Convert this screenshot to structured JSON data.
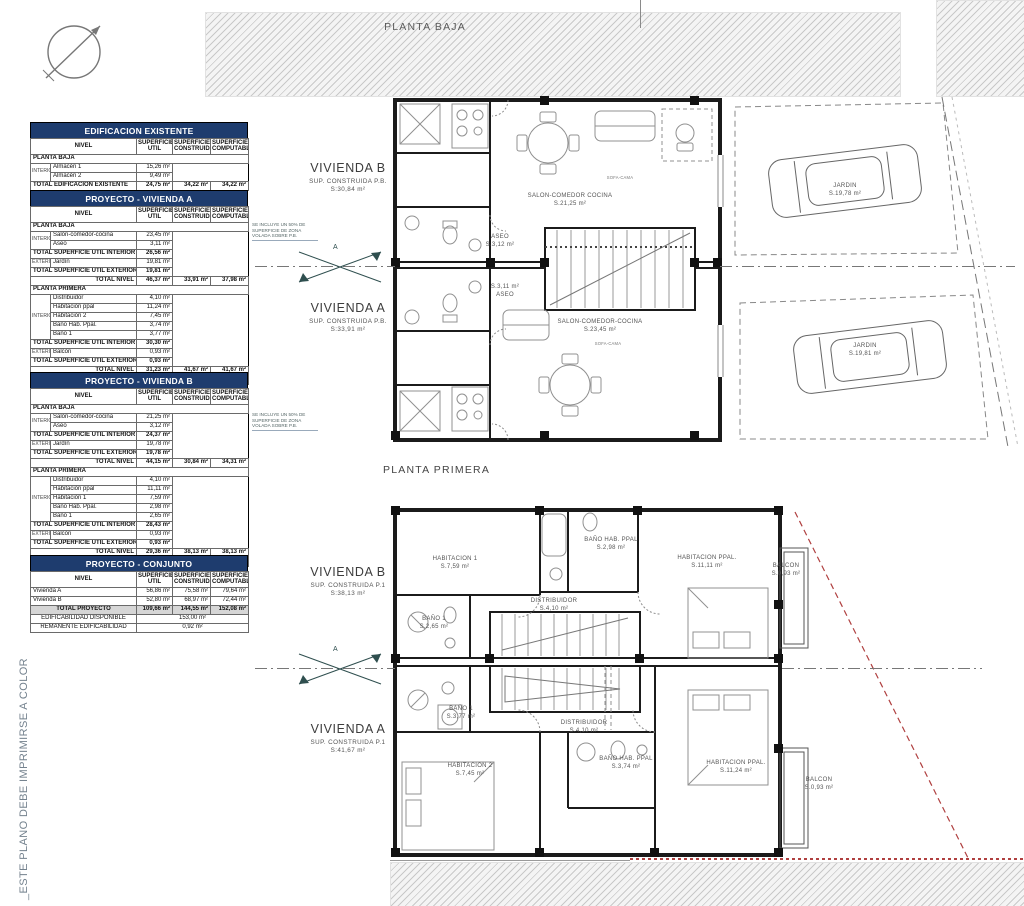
{
  "colors": {
    "table_header_bg": "#1e3c6e",
    "red_boundary": "#b04040",
    "side_note_color": "#74828e"
  },
  "side_note": "_ESTE PLANO DEBE IMPRIMIRSE A COLOR",
  "section_marker_label": "A",
  "tables": [
    {
      "title": "EDIFICACION EXISTENTE",
      "rows": [
        [
          {
            "t": "NIVEL",
            "cs": 2,
            "c": "hdr"
          },
          {
            "t": "SUPERFICIE UTIL",
            "c": "hdr"
          },
          {
            "t": "SUPERFICIE CONSTRUIDA",
            "c": "hdr"
          },
          {
            "t": "SUPERFICIE COMPUTABLE",
            "c": "hdr"
          }
        ],
        [
          {
            "t": "PLANTA BAJA",
            "cs": 5,
            "c": "sec"
          }
        ],
        [
          {
            "t": "INTERIOR",
            "rs": 2,
            "c": "grp"
          },
          {
            "t": "Almacén 1",
            "c": "lbl"
          },
          {
            "t": "15,26 m²",
            "c": "num"
          },
          {
            "t": "",
            "c": "blank"
          },
          {
            "t": "",
            "c": "blank"
          }
        ],
        [
          {
            "t": "Almacén 2",
            "c": "lbl"
          },
          {
            "t": "9,49 m²",
            "c": "num"
          },
          {
            "t": "",
            "c": "blank"
          },
          {
            "t": "",
            "c": "blank"
          }
        ],
        [
          {
            "t": "TOTAL EDIFICACION EXISTENTE",
            "cs": 2,
            "c": "b lbl"
          },
          {
            "t": "24,75 m²",
            "c": "num b"
          },
          {
            "t": "34,22 m²",
            "c": "num b"
          },
          {
            "t": "34,22 m²",
            "c": "num b"
          }
        ]
      ]
    },
    {
      "title": "PROYECTO - VIVIENDA A",
      "rows": [
        [
          {
            "t": "NIVEL",
            "cs": 2,
            "c": "hdr"
          },
          {
            "t": "SUPERFICIE UTIL",
            "c": "hdr"
          },
          {
            "t": "SUPERFICIE CONSTRUIDA",
            "c": "hdr"
          },
          {
            "t": "SUPERFICIE COMPUTABLE",
            "c": "hdr"
          }
        ],
        [
          {
            "t": "PLANTA BAJA",
            "cs": 5,
            "c": "sec"
          }
        ],
        [
          {
            "t": "INTERIOR",
            "rs": 2,
            "c": "grp"
          },
          {
            "t": "Salón-comedor-cocina",
            "c": "lbl"
          },
          {
            "t": "23,45 m²",
            "c": "num"
          },
          {
            "t": "",
            "c": "blank"
          },
          {
            "t": "",
            "c": "blank"
          }
        ],
        [
          {
            "t": "Aseo",
            "c": "lbl"
          },
          {
            "t": "3,11 m²",
            "c": "num"
          },
          {
            "t": "",
            "c": "blank"
          },
          {
            "t": "",
            "c": "blank"
          }
        ],
        [
          {
            "t": "TOTAL SUPERFICIE UTIL INTERIOR",
            "cs": 2,
            "c": "b lbl"
          },
          {
            "t": "26,56 m²",
            "c": "num b"
          },
          {
            "t": "",
            "c": "blank"
          },
          {
            "t": "",
            "c": "blank"
          }
        ],
        [
          {
            "t": "EXTERIOR",
            "c": "grp"
          },
          {
            "t": "Jardín",
            "c": "lbl"
          },
          {
            "t": "19,81 m²",
            "c": "num"
          },
          {
            "t": "",
            "c": "blank"
          },
          {
            "t": "",
            "c": "blank"
          }
        ],
        [
          {
            "t": "TOTAL SUPERFICIE UTIL EXTERIOR",
            "cs": 2,
            "c": "b lbl"
          },
          {
            "t": "19,81 m²",
            "c": "num b"
          },
          {
            "t": "",
            "c": "blank"
          },
          {
            "t": "",
            "c": "blank"
          }
        ],
        [
          {
            "t": "TOTAL NIVEL",
            "cs": 2,
            "c": "b r"
          },
          {
            "t": "46,37 m²",
            "c": "num b"
          },
          {
            "t": "33,91 m²",
            "c": "num b"
          },
          {
            "t": "37,98 m²",
            "c": "num b"
          }
        ],
        [
          {
            "t": "PLANTA PRIMERA",
            "cs": 5,
            "c": "sec"
          }
        ],
        [
          {
            "t": "INTERIOR",
            "rs": 5,
            "c": "grp"
          },
          {
            "t": "Distribuidor",
            "c": "lbl"
          },
          {
            "t": "4,10 m²",
            "c": "num"
          },
          {
            "t": "",
            "c": "blank"
          },
          {
            "t": "",
            "c": "blank"
          }
        ],
        [
          {
            "t": "Habitación ppal",
            "c": "lbl"
          },
          {
            "t": "11,24 m²",
            "c": "num"
          },
          {
            "t": "",
            "c": "blank"
          },
          {
            "t": "",
            "c": "blank"
          }
        ],
        [
          {
            "t": "Habitación 2",
            "c": "lbl"
          },
          {
            "t": "7,45 m²",
            "c": "num"
          },
          {
            "t": "",
            "c": "blank"
          },
          {
            "t": "",
            "c": "blank"
          }
        ],
        [
          {
            "t": "Baño Hab. Ppal.",
            "c": "lbl"
          },
          {
            "t": "3,74 m²",
            "c": "num"
          },
          {
            "t": "",
            "c": "blank"
          },
          {
            "t": "",
            "c": "blank"
          }
        ],
        [
          {
            "t": "Baño 1",
            "c": "lbl"
          },
          {
            "t": "3,77 m²",
            "c": "num"
          },
          {
            "t": "",
            "c": "blank"
          },
          {
            "t": "",
            "c": "blank"
          }
        ],
        [
          {
            "t": "TOTAL SUPERFICIE UTIL INTERIOR",
            "cs": 2,
            "c": "b lbl"
          },
          {
            "t": "30,30 m²",
            "c": "num b"
          },
          {
            "t": "",
            "c": "blank"
          },
          {
            "t": "",
            "c": "blank"
          }
        ],
        [
          {
            "t": "EXTERIOR",
            "c": "grp"
          },
          {
            "t": "Balcón",
            "c": "lbl"
          },
          {
            "t": "0,93 m²",
            "c": "num"
          },
          {
            "t": "",
            "c": "blank"
          },
          {
            "t": "",
            "c": "blank"
          }
        ],
        [
          {
            "t": "TOTAL SUPERFICIE UTIL EXTERIOR",
            "cs": 2,
            "c": "b lbl"
          },
          {
            "t": "0,93 m²",
            "c": "num b"
          },
          {
            "t": "",
            "c": "blank"
          },
          {
            "t": "",
            "c": "blank"
          }
        ],
        [
          {
            "t": "TOTAL NIVEL",
            "cs": 2,
            "c": "b r"
          },
          {
            "t": "31,23 m²",
            "c": "num b"
          },
          {
            "t": "41,67 m²",
            "c": "num b"
          },
          {
            "t": "41,67 m²",
            "c": "num b"
          }
        ],
        [
          {
            "t": "TOTAL VIVIENDA PROYECTO",
            "cs": 2,
            "c": "b lbl gray"
          },
          {
            "t": "56,86 m²",
            "c": "num b gray"
          },
          {
            "t": "75,58 m²",
            "c": "num b gray"
          },
          {
            "t": "79,64 m²",
            "c": "num b gray"
          }
        ]
      ]
    },
    {
      "title": "PROYECTO - VIVIENDA B",
      "rows": [
        [
          {
            "t": "NIVEL",
            "cs": 2,
            "c": "hdr"
          },
          {
            "t": "SUPERFICIE UTIL",
            "c": "hdr"
          },
          {
            "t": "SUPERFICIE CONSTRUIDA",
            "c": "hdr"
          },
          {
            "t": "SUPERFICIE COMPUTABLE",
            "c": "hdr"
          }
        ],
        [
          {
            "t": "PLANTA BAJA",
            "cs": 5,
            "c": "sec"
          }
        ],
        [
          {
            "t": "INTERIOR",
            "rs": 2,
            "c": "grp"
          },
          {
            "t": "Salón-comedor-cocina",
            "c": "lbl"
          },
          {
            "t": "21,25 m²",
            "c": "num"
          },
          {
            "t": "",
            "c": "blank"
          },
          {
            "t": "",
            "c": "blank"
          }
        ],
        [
          {
            "t": "Aseo",
            "c": "lbl"
          },
          {
            "t": "3,12 m²",
            "c": "num"
          },
          {
            "t": "",
            "c": "blank"
          },
          {
            "t": "",
            "c": "blank"
          }
        ],
        [
          {
            "t": "TOTAL SUPERFICIE UTIL INTERIOR",
            "cs": 2,
            "c": "b lbl"
          },
          {
            "t": "24,37 m²",
            "c": "num b"
          },
          {
            "t": "",
            "c": "blank"
          },
          {
            "t": "",
            "c": "blank"
          }
        ],
        [
          {
            "t": "EXTERIOR",
            "c": "grp"
          },
          {
            "t": "Jardín",
            "c": "lbl"
          },
          {
            "t": "19,78 m²",
            "c": "num"
          },
          {
            "t": "",
            "c": "blank"
          },
          {
            "t": "",
            "c": "blank"
          }
        ],
        [
          {
            "t": "TOTAL SUPERFICIE UTIL EXTERIOR",
            "cs": 2,
            "c": "b lbl"
          },
          {
            "t": "19,78 m²",
            "c": "num b"
          },
          {
            "t": "",
            "c": "blank"
          },
          {
            "t": "",
            "c": "blank"
          }
        ],
        [
          {
            "t": "TOTAL NIVEL",
            "cs": 2,
            "c": "b r"
          },
          {
            "t": "44,15 m²",
            "c": "num b"
          },
          {
            "t": "30,84 m²",
            "c": "num b"
          },
          {
            "t": "34,31 m²",
            "c": "num b"
          }
        ],
        [
          {
            "t": "PLANTA PRIMERA",
            "cs": 5,
            "c": "sec"
          }
        ],
        [
          {
            "t": "INTERIOR",
            "rs": 5,
            "c": "grp"
          },
          {
            "t": "Distribuidor",
            "c": "lbl"
          },
          {
            "t": "4,10 m²",
            "c": "num"
          },
          {
            "t": "",
            "c": "blank"
          },
          {
            "t": "",
            "c": "blank"
          }
        ],
        [
          {
            "t": "Habitación ppal",
            "c": "lbl"
          },
          {
            "t": "11,11 m²",
            "c": "num"
          },
          {
            "t": "",
            "c": "blank"
          },
          {
            "t": "",
            "c": "blank"
          }
        ],
        [
          {
            "t": "Habitación 1",
            "c": "lbl"
          },
          {
            "t": "7,59 m²",
            "c": "num"
          },
          {
            "t": "",
            "c": "blank"
          },
          {
            "t": "",
            "c": "blank"
          }
        ],
        [
          {
            "t": "Baño Hab. Ppal.",
            "c": "lbl"
          },
          {
            "t": "2,98 m²",
            "c": "num"
          },
          {
            "t": "",
            "c": "blank"
          },
          {
            "t": "",
            "c": "blank"
          }
        ],
        [
          {
            "t": "Baño 1",
            "c": "lbl"
          },
          {
            "t": "2,65 m²",
            "c": "num"
          },
          {
            "t": "",
            "c": "blank"
          },
          {
            "t": "",
            "c": "blank"
          }
        ],
        [
          {
            "t": "TOTAL SUPERFICIE UTIL INTERIOR",
            "cs": 2,
            "c": "b lbl"
          },
          {
            "t": "28,43 m²",
            "c": "num b"
          },
          {
            "t": "",
            "c": "blank"
          },
          {
            "t": "",
            "c": "blank"
          }
        ],
        [
          {
            "t": "EXTERIOR",
            "c": "grp"
          },
          {
            "t": "Balcón",
            "c": "lbl"
          },
          {
            "t": "0,93 m²",
            "c": "num"
          },
          {
            "t": "",
            "c": "blank"
          },
          {
            "t": "",
            "c": "blank"
          }
        ],
        [
          {
            "t": "TOTAL SUPERFICIE UTIL EXTERIOR",
            "cs": 2,
            "c": "b lbl"
          },
          {
            "t": "0,93 m²",
            "c": "num b"
          },
          {
            "t": "",
            "c": "blank"
          },
          {
            "t": "",
            "c": "blank"
          }
        ],
        [
          {
            "t": "TOTAL NIVEL",
            "cs": 2,
            "c": "b r"
          },
          {
            "t": "29,36 m²",
            "c": "num b"
          },
          {
            "t": "38,13 m²",
            "c": "num b"
          },
          {
            "t": "38,13 m²",
            "c": "num b"
          }
        ],
        [
          {
            "t": "TOTAL VIVIENDA PROYECTO",
            "cs": 2,
            "c": "b lbl gray"
          },
          {
            "t": "52,80 m²",
            "c": "num b gray"
          },
          {
            "t": "68,97 m²",
            "c": "num b gray"
          },
          {
            "t": "72,44 m²",
            "c": "num b gray"
          }
        ]
      ]
    },
    {
      "title": "PROYECTO - CONJUNTO",
      "rows": [
        [
          {
            "t": "NIVEL",
            "cs": 2,
            "c": "hdr"
          },
          {
            "t": "SUPERFICIE UTIL",
            "c": "hdr"
          },
          {
            "t": "SUPERFICIE CONSTRUIDA",
            "c": "hdr"
          },
          {
            "t": "SUPERFICIE COMPUTABLE",
            "c": "hdr"
          }
        ],
        [
          {
            "t": "Vivienda A",
            "cs": 2,
            "c": "lbl"
          },
          {
            "t": "56,86 m²",
            "c": "num"
          },
          {
            "t": "75,58 m²",
            "c": "num"
          },
          {
            "t": "79,64 m²",
            "c": "num"
          }
        ],
        [
          {
            "t": "Vivienda B",
            "cs": 2,
            "c": "lbl"
          },
          {
            "t": "52,80 m²",
            "c": "num"
          },
          {
            "t": "68,97 m²",
            "c": "num"
          },
          {
            "t": "72,44 m²",
            "c": "num"
          }
        ],
        [
          {
            "t": "TOTAL PROYECTO",
            "cs": 2,
            "c": "b ctr gray"
          },
          {
            "t": "109,66 m²",
            "c": "num b gray"
          },
          {
            "t": "144,55 m²",
            "c": "num b gray"
          },
          {
            "t": "152,08 m²",
            "c": "num b gray"
          }
        ],
        [
          {
            "t": "EDIFICABILIDAD DISPONIBLE",
            "cs": 2,
            "c": "ctr"
          },
          {
            "t": "153,00 m²",
            "cs": 3,
            "c": "ctr"
          }
        ],
        [
          {
            "t": "REMANENTE EDIFICABILIDAD",
            "cs": 2,
            "c": "ctr"
          },
          {
            "t": "0,92 m²",
            "cs": 3,
            "c": "ctr"
          }
        ]
      ]
    }
  ],
  "plans": {
    "pb": {
      "title": "PLANTA BAJA",
      "note_lines": [
        "SE INCLUYE UN 50% DE",
        "SUPERFICIE DE ZONA",
        "VOLADA SOBRE P.B."
      ],
      "vivienda_b": {
        "name": "VIVIENDA B",
        "sub": "SUP. CONSTRUIDA P.B.",
        "area": "S:30,84 m²"
      },
      "vivienda_a": {
        "name": "VIVIENDA A",
        "sub": "SUP. CONSTRUIDA P.B.",
        "area": "S:33,91 m²"
      },
      "rooms": {
        "aseo_b": {
          "l1": "ASEO",
          "l2": "S.3,12 m²"
        },
        "salon_b": {
          "l1": "SALON-COMEDOR COCINA",
          "l2": "S.21,25 m²"
        },
        "sofa_b": {
          "l1": "SOFA-CAMA"
        },
        "jardin_b": {
          "l1": "JARDIN",
          "l2": "S.19,78 m²"
        },
        "aseo_a": {
          "l1": "S.3,11 m²",
          "l2": "ASEO"
        },
        "salon_a": {
          "l1": "SALON-COMEDOR-COCINA",
          "l2": "S.23,45 m²"
        },
        "sofa_a": {
          "l1": "SOFA-CAMA"
        },
        "jardin_a": {
          "l1": "JARDIN",
          "l2": "S.19,81 m²"
        }
      }
    },
    "p1": {
      "title": "PLANTA PRIMERA",
      "vivienda_b": {
        "name": "VIVIENDA B",
        "sub": "SUP. CONSTRUIDA P.1",
        "area": "S:38,13 m²"
      },
      "vivienda_a": {
        "name": "VIVIENDA A",
        "sub": "SUP. CONSTRUIDA P.1",
        "area": "S:41,67 m²"
      },
      "rooms": {
        "hab1_b": {
          "l1": "HABITACION 1",
          "l2": "S.7,59 m²"
        },
        "bano_hab_b": {
          "l1": "BAÑO HAB. PPAL",
          "l2": "S.2,98 m²"
        },
        "hab_ppal_b": {
          "l1": "HABITACION PPAL.",
          "l2": "S.11,11 m²"
        },
        "balcon_b": {
          "l1": "BALCON",
          "l2": "S.0,93 m²"
        },
        "distribuidor_b": {
          "l1": "DISTRIBUIDOR",
          "l2": "S.4,10 m²"
        },
        "bano1_b": {
          "l1": "BAÑO 1",
          "l2": "S.2,65 m²"
        },
        "bano1_a": {
          "l1": "BAÑO 1",
          "l2": "S.3,77 m²"
        },
        "distribuidor_a": {
          "l1": "DISTRIBUIDOR",
          "l2": "S.4,10 m²"
        },
        "hab2_a": {
          "l1": "HABITACION 2",
          "l2": "S.7,45 m²"
        },
        "bano_hab_a": {
          "l1": "BAÑO HAB. PPAL",
          "l2": "S.3,74 m²"
        },
        "hab_ppal_a": {
          "l1": "HABITACION PPAL.",
          "l2": "S.11,24 m²"
        },
        "balcon_a": {
          "l1": "BALCON",
          "l2": "S.0,93 m²"
        }
      }
    }
  }
}
